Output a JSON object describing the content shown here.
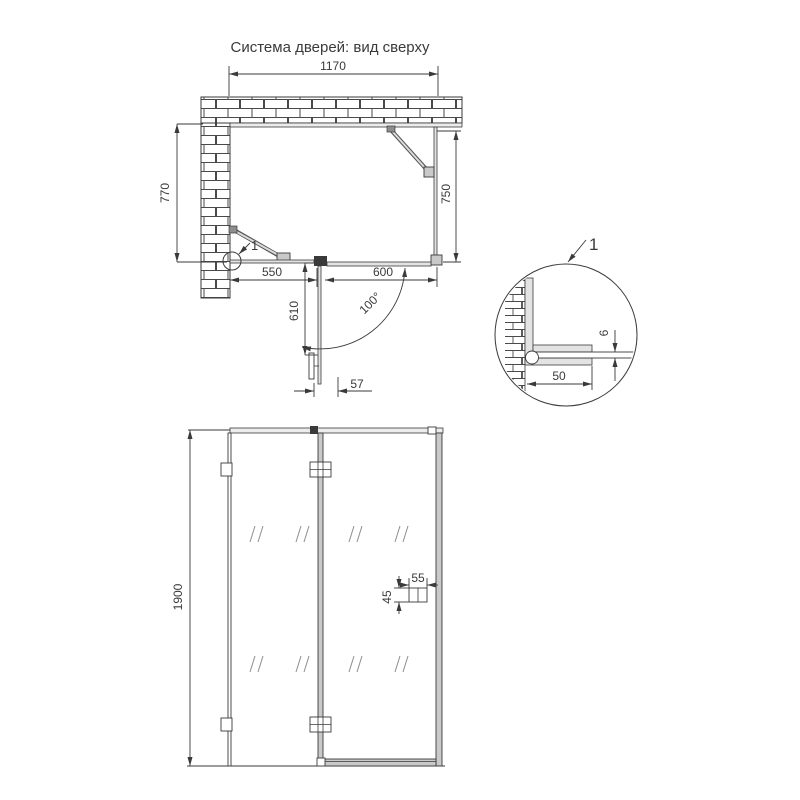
{
  "colors": {
    "line": "#3a3a3a",
    "background": "#ffffff",
    "profile_fill": "#c9c9c9",
    "glass_fill": "#e3e3e3"
  },
  "title": "Система дверей: вид сверху",
  "plan_view": {
    "dim_total_width": "1170",
    "dim_left_wall": "770",
    "dim_right_side": "750",
    "dim_fixed_panel": "550",
    "dim_door_width": "600",
    "dim_door_open": "610",
    "dim_handle_offset": "57",
    "door_open_angle": "100°",
    "detail_marker": "1"
  },
  "detail_view": {
    "label": "1",
    "dim_profile_width": "50",
    "dim_glass_thickness": "6"
  },
  "elevation_view": {
    "dim_height": "1900",
    "dim_handle_width": "55",
    "dim_handle_height": "45"
  }
}
